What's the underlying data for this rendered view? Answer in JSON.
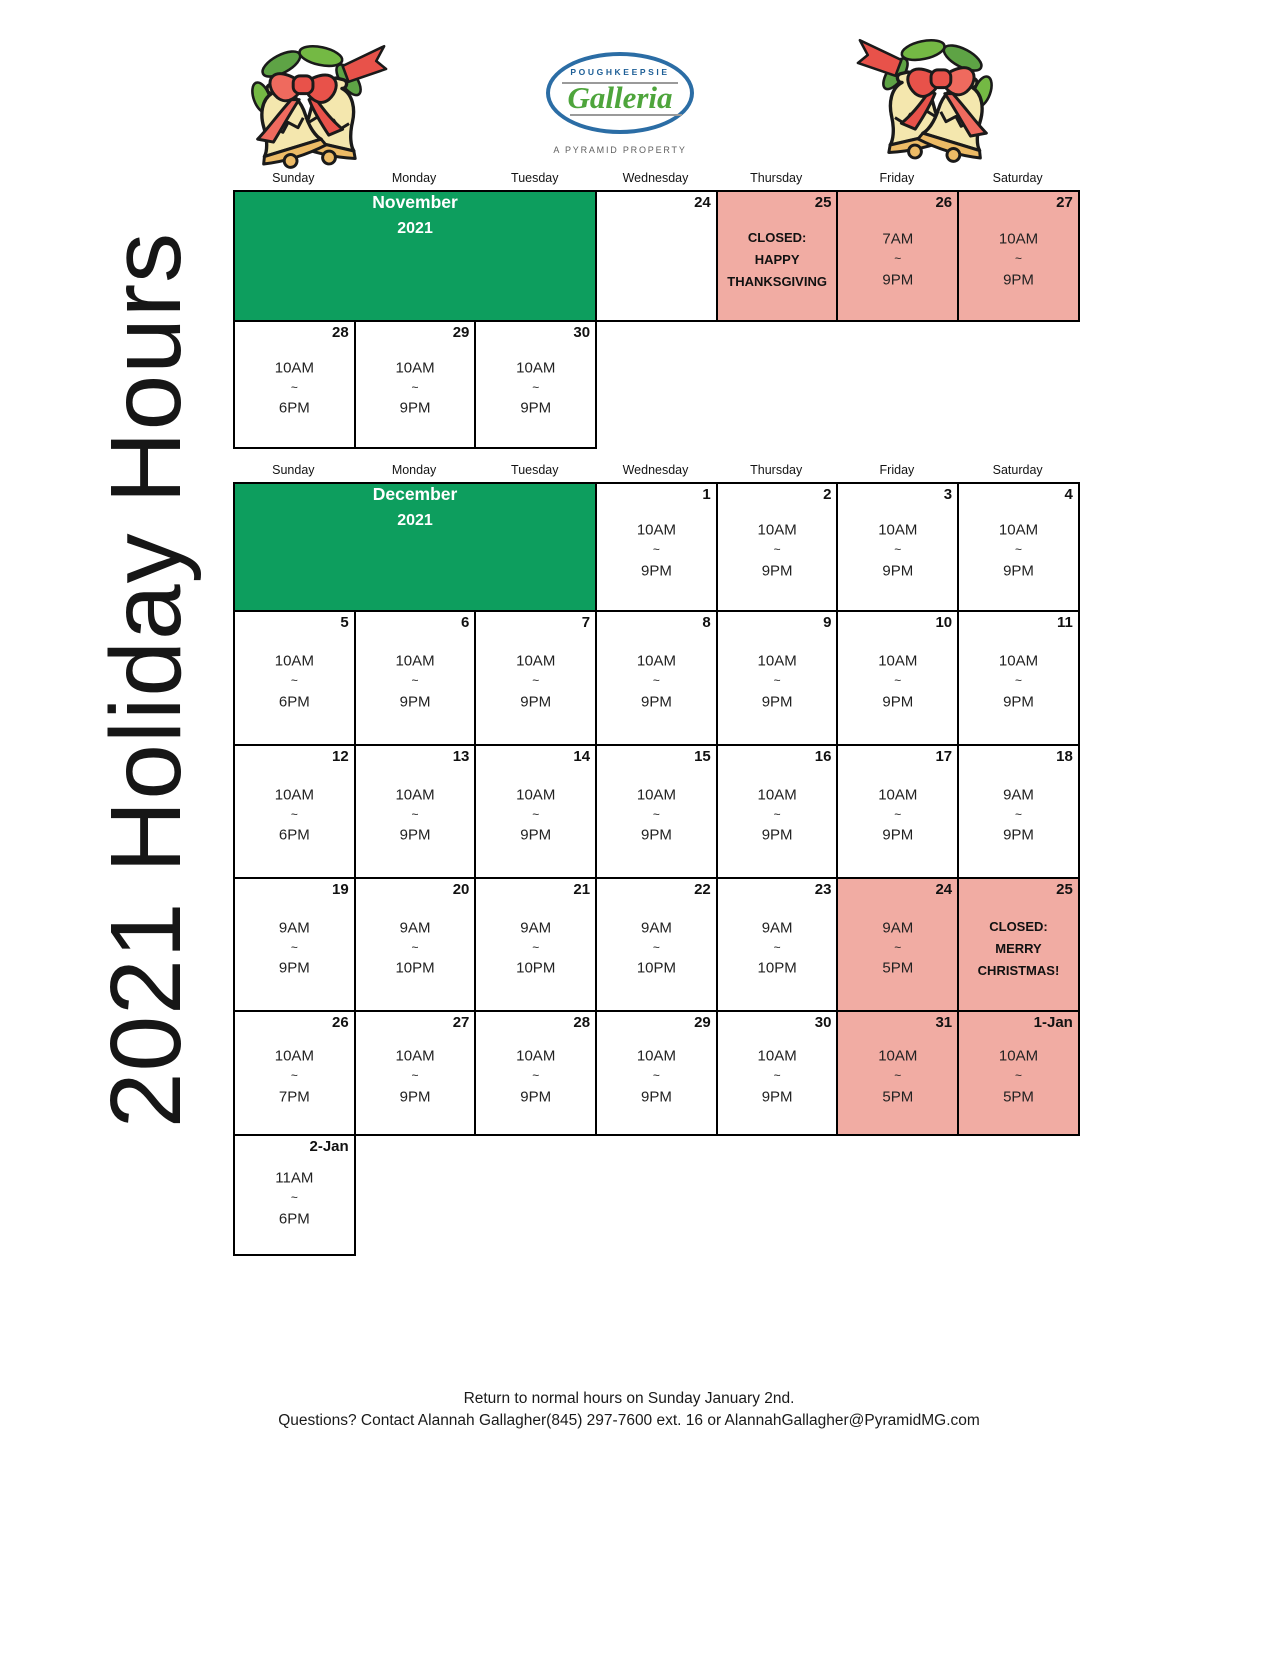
{
  "page": {
    "vertical_title": "2021 Holiday Hours",
    "footer_line1": "Return to normal hours on Sunday January 2nd.",
    "footer_line2": "Questions? Contact Alannah Gallagher(845) 297-7600 ext. 16 or AlannahGallagher@PyramidMG.com"
  },
  "logo": {
    "top_text": "POUGHKEEPSIE",
    "script_text": "Galleria",
    "subtitle": "A PYRAMID PROPERTY"
  },
  "decorations": {
    "left": "christmas-bells",
    "right": "christmas-bells"
  },
  "colors": {
    "calendar_green": "#0d9e5e",
    "calendar_pink": "#f1aca3",
    "logo_blue": "#2b6da5",
    "logo_text_blue": "#1d5e96",
    "logo_green": "#4ea53c",
    "logo_gray": "#5f5f5f",
    "border_black": "#000000"
  },
  "weekday_headers": [
    "Sunday",
    "Monday",
    "Tuesday",
    "Wednesday",
    "Thursday",
    "Friday",
    "Saturday"
  ],
  "november": {
    "month_title_line1": "November",
    "month_title_line2": "2021",
    "rows": [
      {
        "cells": [
          {
            "month": true,
            "span": 3
          },
          {
            "date": "24",
            "lines": [],
            "bg": "white"
          },
          {
            "date": "25",
            "lines": [
              "CLOSED:",
              "HAPPY",
              "THANKSGIVING"
            ],
            "bg": "pink",
            "bold": true
          },
          {
            "date": "26",
            "lines": [
              "7AM",
              "~",
              "9PM"
            ],
            "bg": "pink"
          },
          {
            "date": "27",
            "lines": [
              "10AM",
              "~",
              "9PM"
            ],
            "bg": "pink"
          }
        ]
      },
      {
        "cells": [
          {
            "date": "28",
            "lines": [
              "10AM",
              "~",
              "6PM"
            ],
            "bg": "white"
          },
          {
            "date": "29",
            "lines": [
              "10AM",
              "~",
              "9PM"
            ],
            "bg": "white"
          },
          {
            "date": "30",
            "lines": [
              "10AM",
              "~",
              "9PM"
            ],
            "bg": "white"
          }
        ]
      }
    ]
  },
  "december": {
    "month_title_line1": "December",
    "month_title_line2": "2021",
    "rows": [
      {
        "cells": [
          {
            "month": true,
            "span": 3
          },
          {
            "date": "1",
            "lines": [
              "10AM",
              "~",
              "9PM"
            ],
            "bg": "white"
          },
          {
            "date": "2",
            "lines": [
              "10AM",
              "~",
              "9PM"
            ],
            "bg": "white"
          },
          {
            "date": "3",
            "lines": [
              "10AM",
              "~",
              "9PM"
            ],
            "bg": "white"
          },
          {
            "date": "4",
            "lines": [
              "10AM",
              "~",
              "9PM"
            ],
            "bg": "white"
          }
        ]
      },
      {
        "cells": [
          {
            "date": "5",
            "lines": [
              "10AM",
              "~",
              "6PM"
            ],
            "bg": "white"
          },
          {
            "date": "6",
            "lines": [
              "10AM",
              "~",
              "9PM"
            ],
            "bg": "white"
          },
          {
            "date": "7",
            "lines": [
              "10AM",
              "~",
              "9PM"
            ],
            "bg": "white"
          },
          {
            "date": "8",
            "lines": [
              "10AM",
              "~",
              "9PM"
            ],
            "bg": "white"
          },
          {
            "date": "9",
            "lines": [
              "10AM",
              "~",
              "9PM"
            ],
            "bg": "white"
          },
          {
            "date": "10",
            "lines": [
              "10AM",
              "~",
              "9PM"
            ],
            "bg": "white"
          },
          {
            "date": "11",
            "lines": [
              "10AM",
              "~",
              "9PM"
            ],
            "bg": "white"
          }
        ]
      },
      {
        "cells": [
          {
            "date": "12",
            "lines": [
              "10AM",
              "~",
              "6PM"
            ],
            "bg": "white"
          },
          {
            "date": "13",
            "lines": [
              "10AM",
              "~",
              "9PM"
            ],
            "bg": "white"
          },
          {
            "date": "14",
            "lines": [
              "10AM",
              "~",
              "9PM"
            ],
            "bg": "white"
          },
          {
            "date": "15",
            "lines": [
              "10AM",
              "~",
              "9PM"
            ],
            "bg": "white"
          },
          {
            "date": "16",
            "lines": [
              "10AM",
              "~",
              "9PM"
            ],
            "bg": "white"
          },
          {
            "date": "17",
            "lines": [
              "10AM",
              "~",
              "9PM"
            ],
            "bg": "white"
          },
          {
            "date": "18",
            "lines": [
              "9AM",
              "~",
              "9PM"
            ],
            "bg": "white"
          }
        ]
      },
      {
        "cells": [
          {
            "date": "19",
            "lines": [
              "9AM",
              "~",
              "9PM"
            ],
            "bg": "white"
          },
          {
            "date": "20",
            "lines": [
              "9AM",
              "~",
              "10PM"
            ],
            "bg": "white"
          },
          {
            "date": "21",
            "lines": [
              "9AM",
              "~",
              "10PM"
            ],
            "bg": "white"
          },
          {
            "date": "22",
            "lines": [
              "9AM",
              "~",
              "10PM"
            ],
            "bg": "white"
          },
          {
            "date": "23",
            "lines": [
              "9AM",
              "~",
              "10PM"
            ],
            "bg": "white"
          },
          {
            "date": "24",
            "lines": [
              "9AM",
              "~",
              "5PM"
            ],
            "bg": "pink"
          },
          {
            "date": "25",
            "lines": [
              "CLOSED:",
              "MERRY",
              "CHRISTMAS!"
            ],
            "bg": "pink",
            "bold": true
          }
        ]
      },
      {
        "cells": [
          {
            "date": "26",
            "lines": [
              "10AM",
              "~",
              "7PM"
            ],
            "bg": "white"
          },
          {
            "date": "27",
            "lines": [
              "10AM",
              "~",
              "9PM"
            ],
            "bg": "white"
          },
          {
            "date": "28",
            "lines": [
              "10AM",
              "~",
              "9PM"
            ],
            "bg": "white"
          },
          {
            "date": "29",
            "lines": [
              "10AM",
              "~",
              "9PM"
            ],
            "bg": "white"
          },
          {
            "date": "30",
            "lines": [
              "10AM",
              "~",
              "9PM"
            ],
            "bg": "white"
          },
          {
            "date": "31",
            "lines": [
              "10AM",
              "~",
              "5PM"
            ],
            "bg": "pink"
          },
          {
            "date": "1-Jan",
            "lines": [
              "10AM",
              "~",
              "5PM"
            ],
            "bg": "pink"
          }
        ]
      },
      {
        "cells": [
          {
            "date": "2-Jan",
            "lines": [
              "11AM",
              "~",
              "6PM"
            ],
            "bg": "white"
          }
        ]
      }
    ]
  }
}
